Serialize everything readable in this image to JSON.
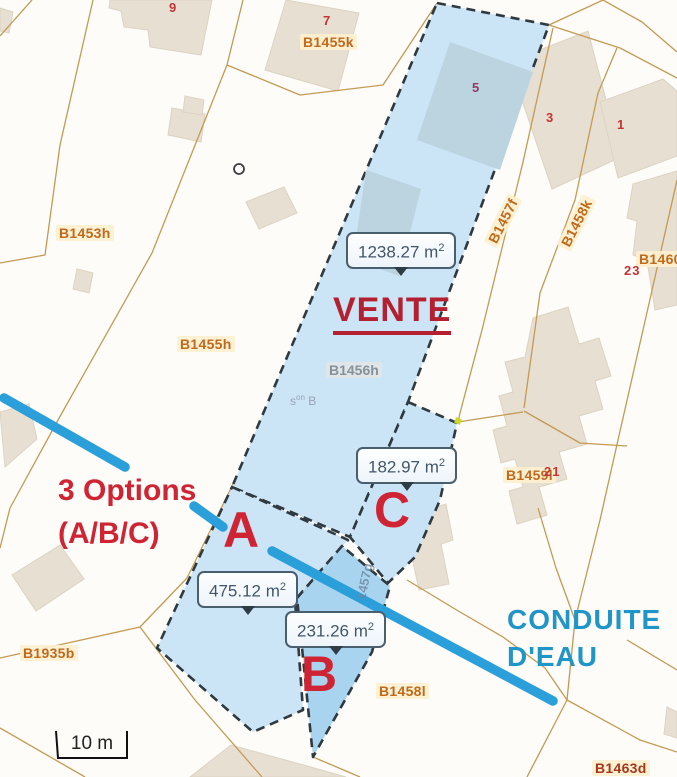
{
  "map": {
    "annotations": {
      "vente": "VENTE",
      "options_line1": "3 Options",
      "options_line2": "(A/B/C)",
      "option_a": "A",
      "option_b": "B",
      "option_c": "C",
      "conduite_line1": "CONDUITE",
      "conduite_line2": "D'EAU"
    },
    "area_tooltips": [
      {
        "value": "1238.27 m",
        "sup": "2"
      },
      {
        "value": "182.97 m",
        "sup": "2"
      },
      {
        "value": "475.12 m",
        "sup": "2"
      },
      {
        "value": "231.26 m",
        "sup": "2"
      }
    ],
    "labels": {
      "b1453h": "B1453h",
      "b1455k": "B1455k",
      "b1455h": "B1455h",
      "b1456h": "B1456h",
      "b1457f": "B1457f",
      "b1458k": "B1458k",
      "b1460": "B1460",
      "b1459l": "B1459l",
      "b1935b": "B1935b",
      "b1458l": "B1458l",
      "b1463d": "B1463d",
      "ref_rotated": "1457g"
    },
    "section_note": {
      "base": "s",
      "sup": "on",
      "rest": " B"
    },
    "numbers": {
      "n9": "9",
      "n7": "7",
      "n5": "5",
      "n3": "3",
      "n1": "1",
      "n23": "23",
      "n21": "21"
    },
    "scale_bar": {
      "label": "10 m"
    },
    "colors": {
      "sale_parcel_fill": "#cbe4f6",
      "parcel_b_fill": "#a9d4ef",
      "building_overlay_on_sale": "#bcd3e0",
      "dashed_border": "#2e3940",
      "boundary_line": "#c49a53",
      "building_beige": "#e7dfd2",
      "conduit_blue": "#2a9fd9",
      "conduite_text_blue": "#2095c8",
      "annotation_red": "#ce2433",
      "vente_red": "#b42030",
      "label_orange": "#bf6a1d",
      "label_gray": "#85929c",
      "label_maroon": "#a5371c",
      "label_halo": "#fdf0cf"
    }
  }
}
